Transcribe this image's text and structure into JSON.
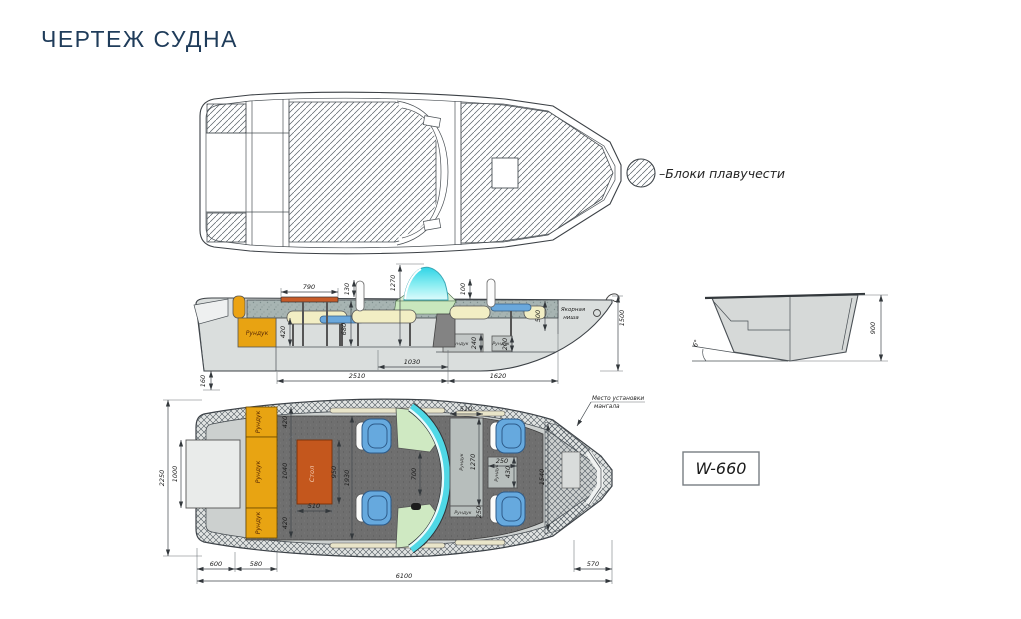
{
  "page": {
    "title": "ЧЕРТЕЖ СУДНА"
  },
  "legend": {
    "label": "–Блоки плавучести"
  },
  "model_badge": "W-660",
  "side_view": {
    "labels": {
      "locker_stern": "Рундук",
      "locker_mid": "Рундук",
      "locker_bow": "Рундук",
      "anchor_niche_1": "Якорная",
      "anchor_niche_2": "ниша"
    },
    "dims": {
      "table_length": "790",
      "post_offset": "130",
      "windshield_height": "1270",
      "bow_post_offset": "100",
      "bow_depth": "500",
      "overall_height": "1500",
      "seat_height": "420",
      "backrest_height": "680",
      "locker_mid_width": "240",
      "locker_bow_width": "200",
      "console_length": "1030",
      "cockpit_length": "2510",
      "foredeck_length": "1620",
      "keel_offset": "160"
    }
  },
  "section_view": {
    "dims": {
      "hull_height": "900",
      "deadrise_angle": "6°"
    }
  },
  "plan_view": {
    "labels": {
      "locker_a": "Рундук",
      "locker_b": "Рундук",
      "locker_c": "Рундук",
      "table": "Стол",
      "locker_bow_long": "Рундук",
      "locker_bow_end": "Рундук",
      "locker_console": "Рундук",
      "grill_note_1": "Место установки",
      "grill_note_2": "мангала"
    },
    "dims": {
      "beam": "2250",
      "platform_width": "1000",
      "locker_a_w": "420",
      "locker_b_w": "1040",
      "locker_c_w": "420",
      "cockpit_width": "1930",
      "table_length": "950",
      "table_width": "510",
      "aisle": "700",
      "bow_locker_width": "510",
      "bow_locker_length": "1270",
      "bow_locker_end": "250",
      "console_width": "250",
      "console_length": "430",
      "bow_beam": "1540",
      "bow_length": "570",
      "stern_seg1": "600",
      "stern_seg2": "580",
      "overall_length": "6100"
    }
  }
}
